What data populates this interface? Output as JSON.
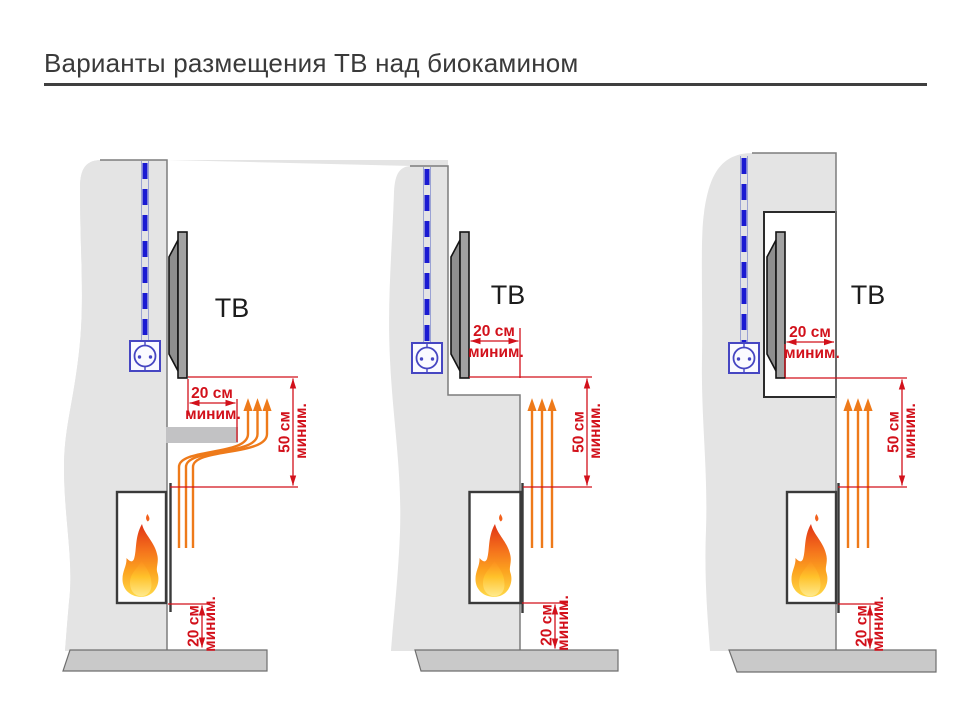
{
  "title": "Варианты размещения ТВ над биокамином",
  "colors": {
    "dimension_red": "#d2111b",
    "heat_arrow_orange": "#ee7a1a",
    "cable_blue": "#1a1ad2",
    "outlet_blue": "#4646c2",
    "wall_gray": "#e4e4e4",
    "shelf_gray": "#c2c2c4",
    "base_gray": "#c9c9c9",
    "tv_gray": "#a2a2a2",
    "flame_orange": "#f4701c",
    "title_color": "#3a3a3a"
  },
  "diagrams": [
    {
      "id": "tv-above-fireplace-with-protective-shelf",
      "tv_label": "ТВ",
      "dim_clearance": {
        "value": "20 см",
        "qualifier": "миним."
      },
      "dim_height": {
        "value": "50 см",
        "qualifier": "миним."
      },
      "dim_floor": {
        "value": "20 см",
        "qualifier": "миним."
      }
    },
    {
      "id": "tv-set-back-from-fireplace-plane",
      "tv_label": "ТВ",
      "dim_clearance": {
        "value": "20 см",
        "qualifier": "миним."
      },
      "dim_height": {
        "value": "50 см",
        "qualifier": "миним."
      },
      "dim_floor": {
        "value": "20 см",
        "qualifier": "миним."
      }
    },
    {
      "id": "tv-in-wall-niche",
      "tv_label": "ТВ",
      "dim_clearance": {
        "value": "20 см",
        "qualifier": "миним."
      },
      "dim_height": {
        "value": "50 см",
        "qualifier": "миним."
      },
      "dim_floor": {
        "value": "20 см",
        "qualifier": "миним."
      }
    }
  ]
}
